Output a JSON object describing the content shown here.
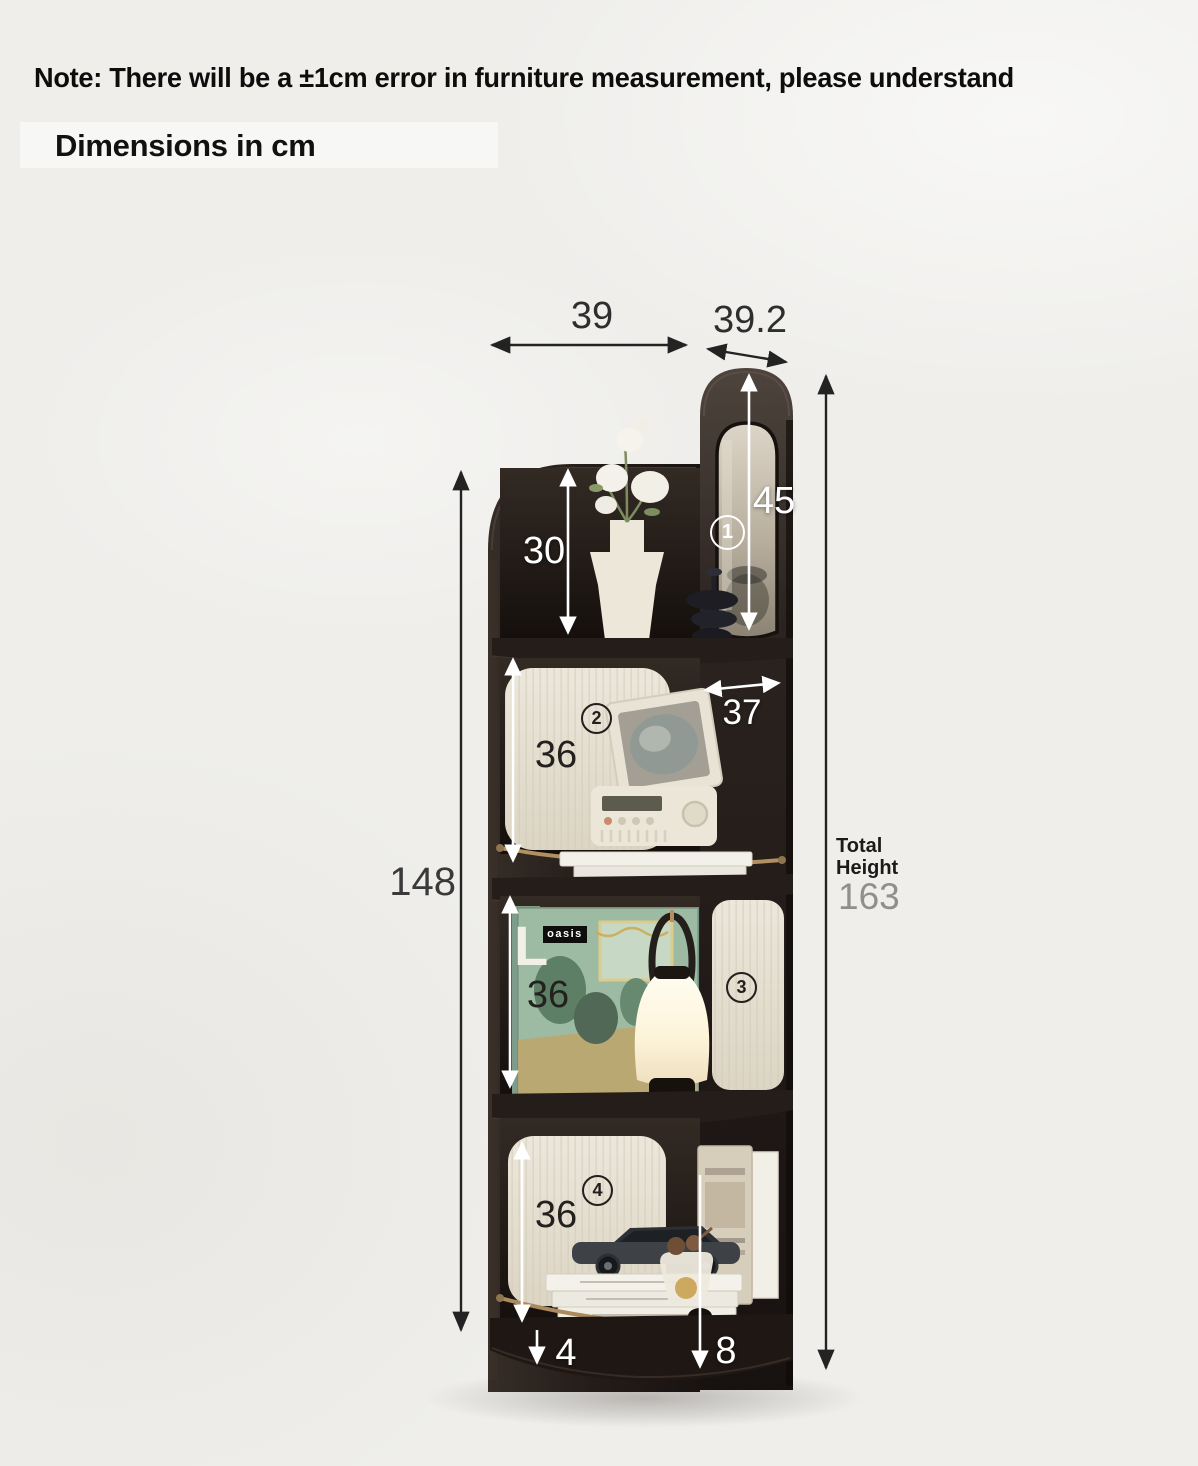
{
  "note": "Note: There will be a ±1cm error in furniture measurement, please understand",
  "title": "Dimensions in cm",
  "dims": {
    "width_top": "39",
    "depth_top": "39.2",
    "mirror_panel_height": "45",
    "top_shelf_height": "30",
    "shelf_depth": "37",
    "shelf2_height": "36",
    "shelf3_height": "36",
    "shelf4_height": "36",
    "side_height": "148",
    "total_label": "Total\nHeight",
    "total_value": "163",
    "base_height": "4",
    "foot_height": "8"
  },
  "markers": {
    "one": "1",
    "two": "2",
    "three": "3",
    "four": "4"
  },
  "album": {
    "brand": "oasis",
    "spine_letter": "L"
  },
  "colors": {
    "background": "#efeeeb",
    "wood_dark": "#241c18",
    "cream_panel": "#e9e4d8",
    "brass": "#b29062",
    "white_label": "#ffffff",
    "dark_label": "#2e2e2e",
    "muted_label": "#8f8f8f"
  }
}
